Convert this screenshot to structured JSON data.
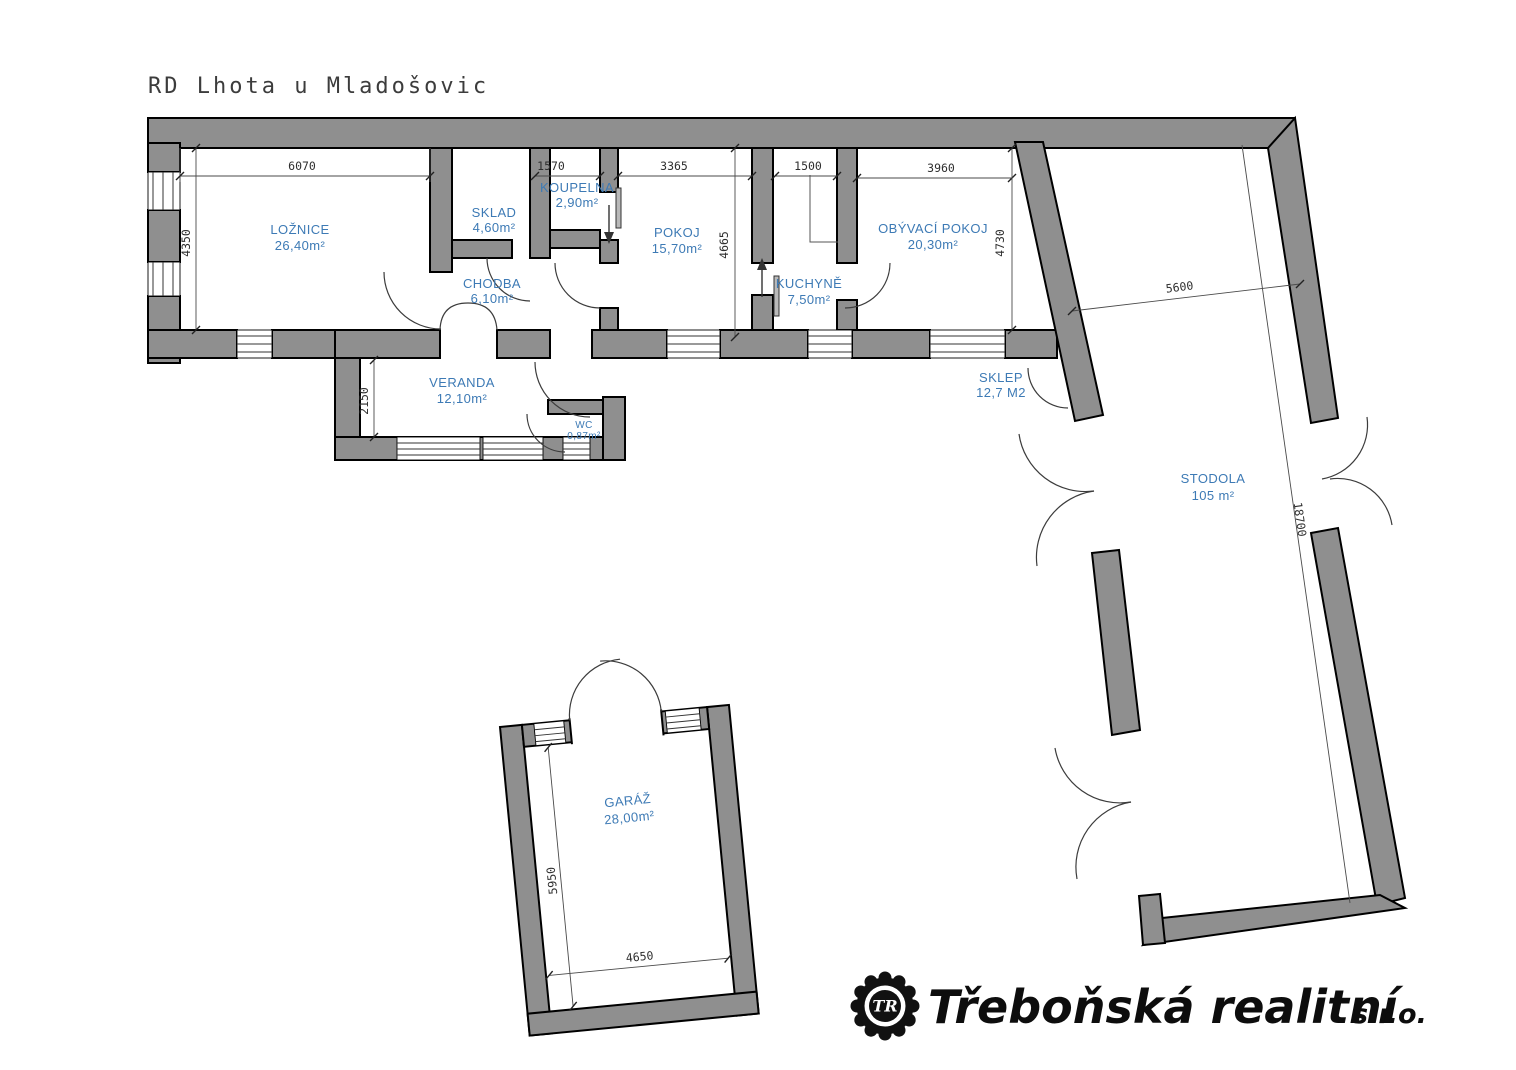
{
  "title": "RD Lhota u Mladošovic",
  "rooms": {
    "loznice": {
      "name": "LOŽNICE",
      "area": "26,40m²"
    },
    "sklad": {
      "name": "SKLAD",
      "area": "4,60m²"
    },
    "koupelna": {
      "name": "KOUPELNA",
      "area": "2,90m²"
    },
    "chodba": {
      "name": "CHODBA",
      "area": "6,10m²"
    },
    "pokoj": {
      "name": "POKOJ",
      "area": "15,70m²"
    },
    "kuchyne": {
      "name": "KUCHYNĚ",
      "area": "7,50m²"
    },
    "obyvaci": {
      "name": "OBÝVACÍ POKOJ",
      "area": "20,30m²"
    },
    "veranda": {
      "name": "VERANDA",
      "area": "12,10m²"
    },
    "wc": {
      "name": "WC",
      "area": "0,87m²"
    },
    "sklep": {
      "name": "SKLEP",
      "area": "12,7 M2"
    },
    "stodola": {
      "name": "STODOLA",
      "area": "105 m²"
    },
    "garaz": {
      "name": "GARÁŽ",
      "area": "28,00m²"
    }
  },
  "dimensions": {
    "loznice_width": "6070",
    "loznice_height": "4350",
    "koupelna_width": "1570",
    "pokoj_width": "3365",
    "pokoj_height": "4665",
    "kuchyne_width": "1500",
    "obyvaci_width": "3960",
    "obyvaci_height": "4730",
    "veranda_height": "2150",
    "stodola_width": "5600",
    "stodola_length": "18700",
    "garaz_height": "5950",
    "garaz_width": "4650"
  },
  "logo": {
    "monogram": "TR",
    "company": "Třeboňská realitní",
    "suffix": "s.r.o."
  },
  "colors": {
    "wall": "#8f8f8f",
    "room_label": "#3d7ab5",
    "line": "#3c3c3c"
  }
}
